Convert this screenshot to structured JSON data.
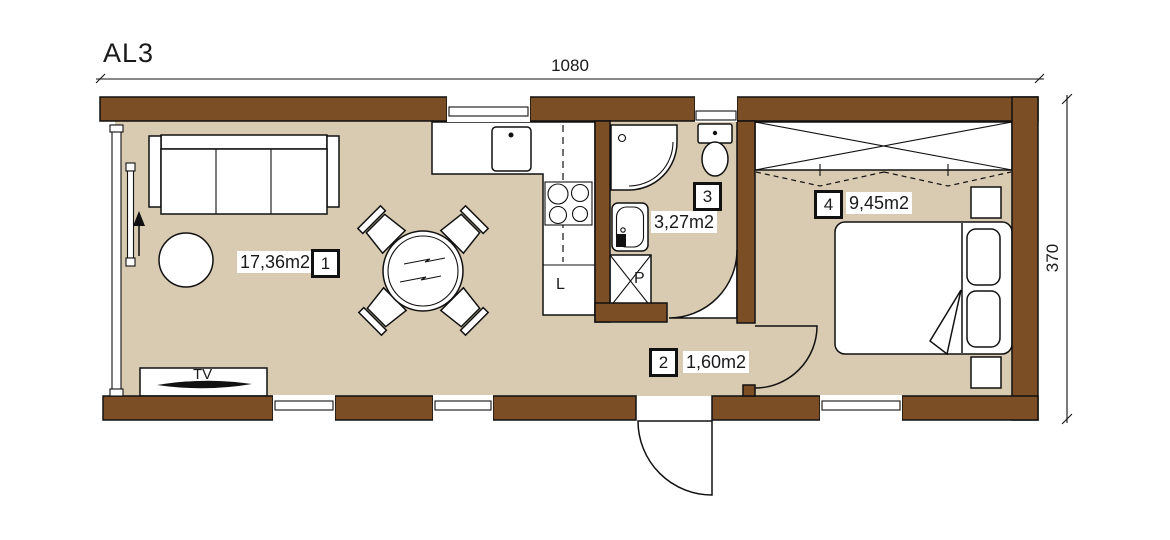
{
  "plan": {
    "title": "AL3"
  },
  "dimensions": {
    "width": "1080",
    "height": "370"
  },
  "rooms": [
    {
      "number": "1",
      "area": "17,36m2"
    },
    {
      "number": "2",
      "area": "1,60m2"
    },
    {
      "number": "3",
      "area": "3,27m2"
    },
    {
      "number": "4",
      "area": "9,45m2"
    }
  ],
  "labels": {
    "tv": "TV",
    "l": "L",
    "p": "P"
  },
  "colors": {
    "wall_fill": "#7c4e26",
    "floor_fill": "#d8cbb1",
    "line": "#111111",
    "background": "#ffffff"
  }
}
